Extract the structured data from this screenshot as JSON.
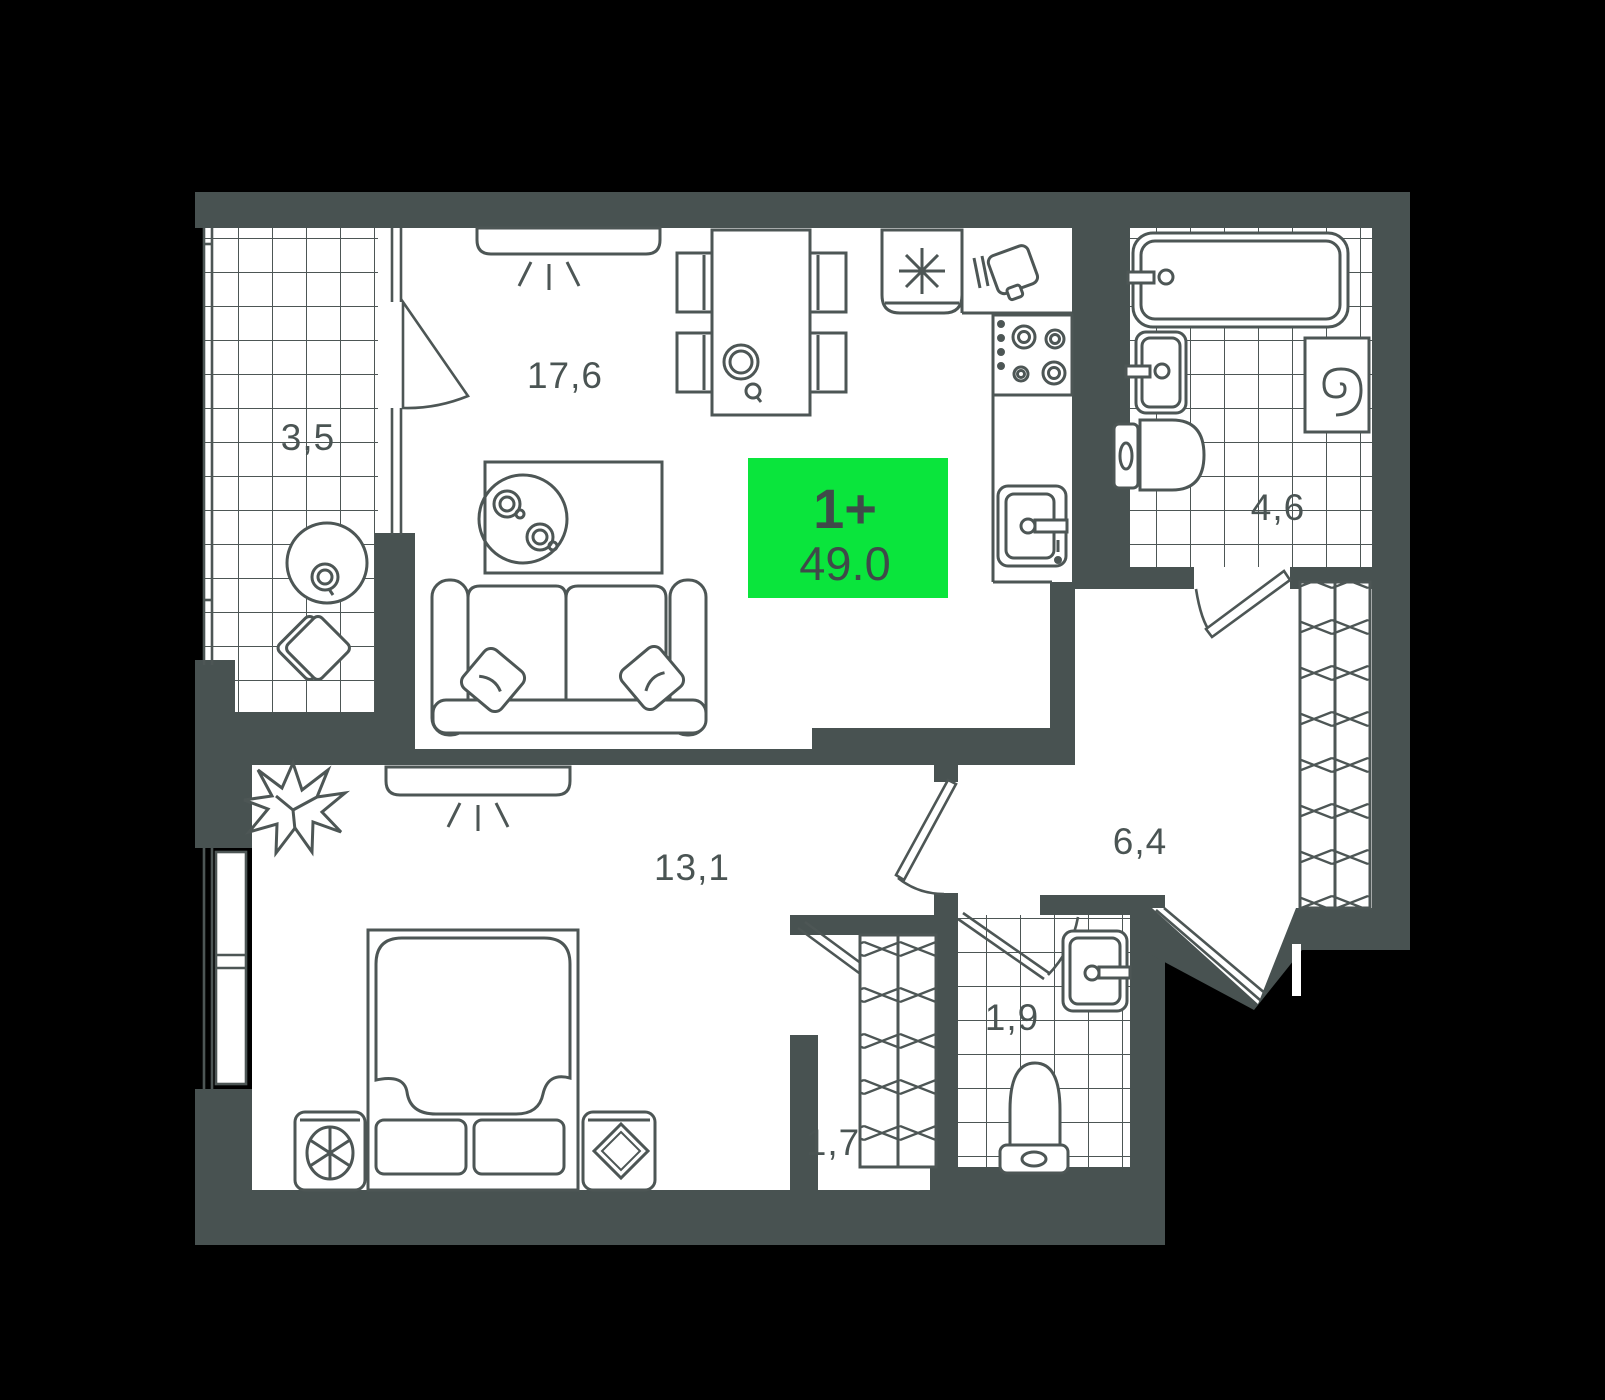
{
  "plan": {
    "title": "apartment-floor-plan",
    "badge": {
      "rooms": "1+",
      "area": "49.0"
    },
    "room_labels": {
      "balcony": "3,5",
      "living_kitchen": "17,6",
      "bathroom": "4,6",
      "hallway": "6,4",
      "bedroom": "13,1",
      "wc": "1,9",
      "closet": "1,7"
    },
    "colors": {
      "background": "#000000",
      "wall": "#485251",
      "floor": "#ffffff",
      "line": "#4d5655",
      "badge_green": "#0ae53c",
      "badge_text": "#3f4a49",
      "label_text": "#4a5453"
    },
    "icons": {
      "sofa-icon": "two-seat sofa with pillows",
      "coffee-table-icon": "table with round tray and two cups",
      "dining-table-icon": "table with four chairs and teapot",
      "fridge-icon": "asterisk symbol",
      "cutting-board-icon": "board with knife marks",
      "cooktop-icon": "four burners",
      "kitchen-sink-icon": "single bowl sink with faucet",
      "bathtub-icon": "tub with faucet",
      "bathroom-sink-icon": "washbasin",
      "toilet-icon": "toilet with tank",
      "washing-machine-icon": "drum spiral",
      "wc-sink-icon": "washbasin",
      "wc-toilet-icon": "toilet with tank",
      "wardrobe-icon": "hatched closet",
      "closet-wardrobe-icon": "hatched closet",
      "bed-icon": "double bed with blanket",
      "ac-unit-icon": "cabinet with fan",
      "decor-stand-icon": "cabinet with diamond",
      "plant-icon": "spiky plant",
      "balcony-table-icon": "round table with cup",
      "pouf-icon": "rotated seat",
      "ceiling-light-icon": "lamp with rays",
      "door-icon": "door leaf with swing arc",
      "entrance-door-icon": "diagonal entrance door in wall notch",
      "window-icon": "double glazing lines with radiator"
    }
  }
}
